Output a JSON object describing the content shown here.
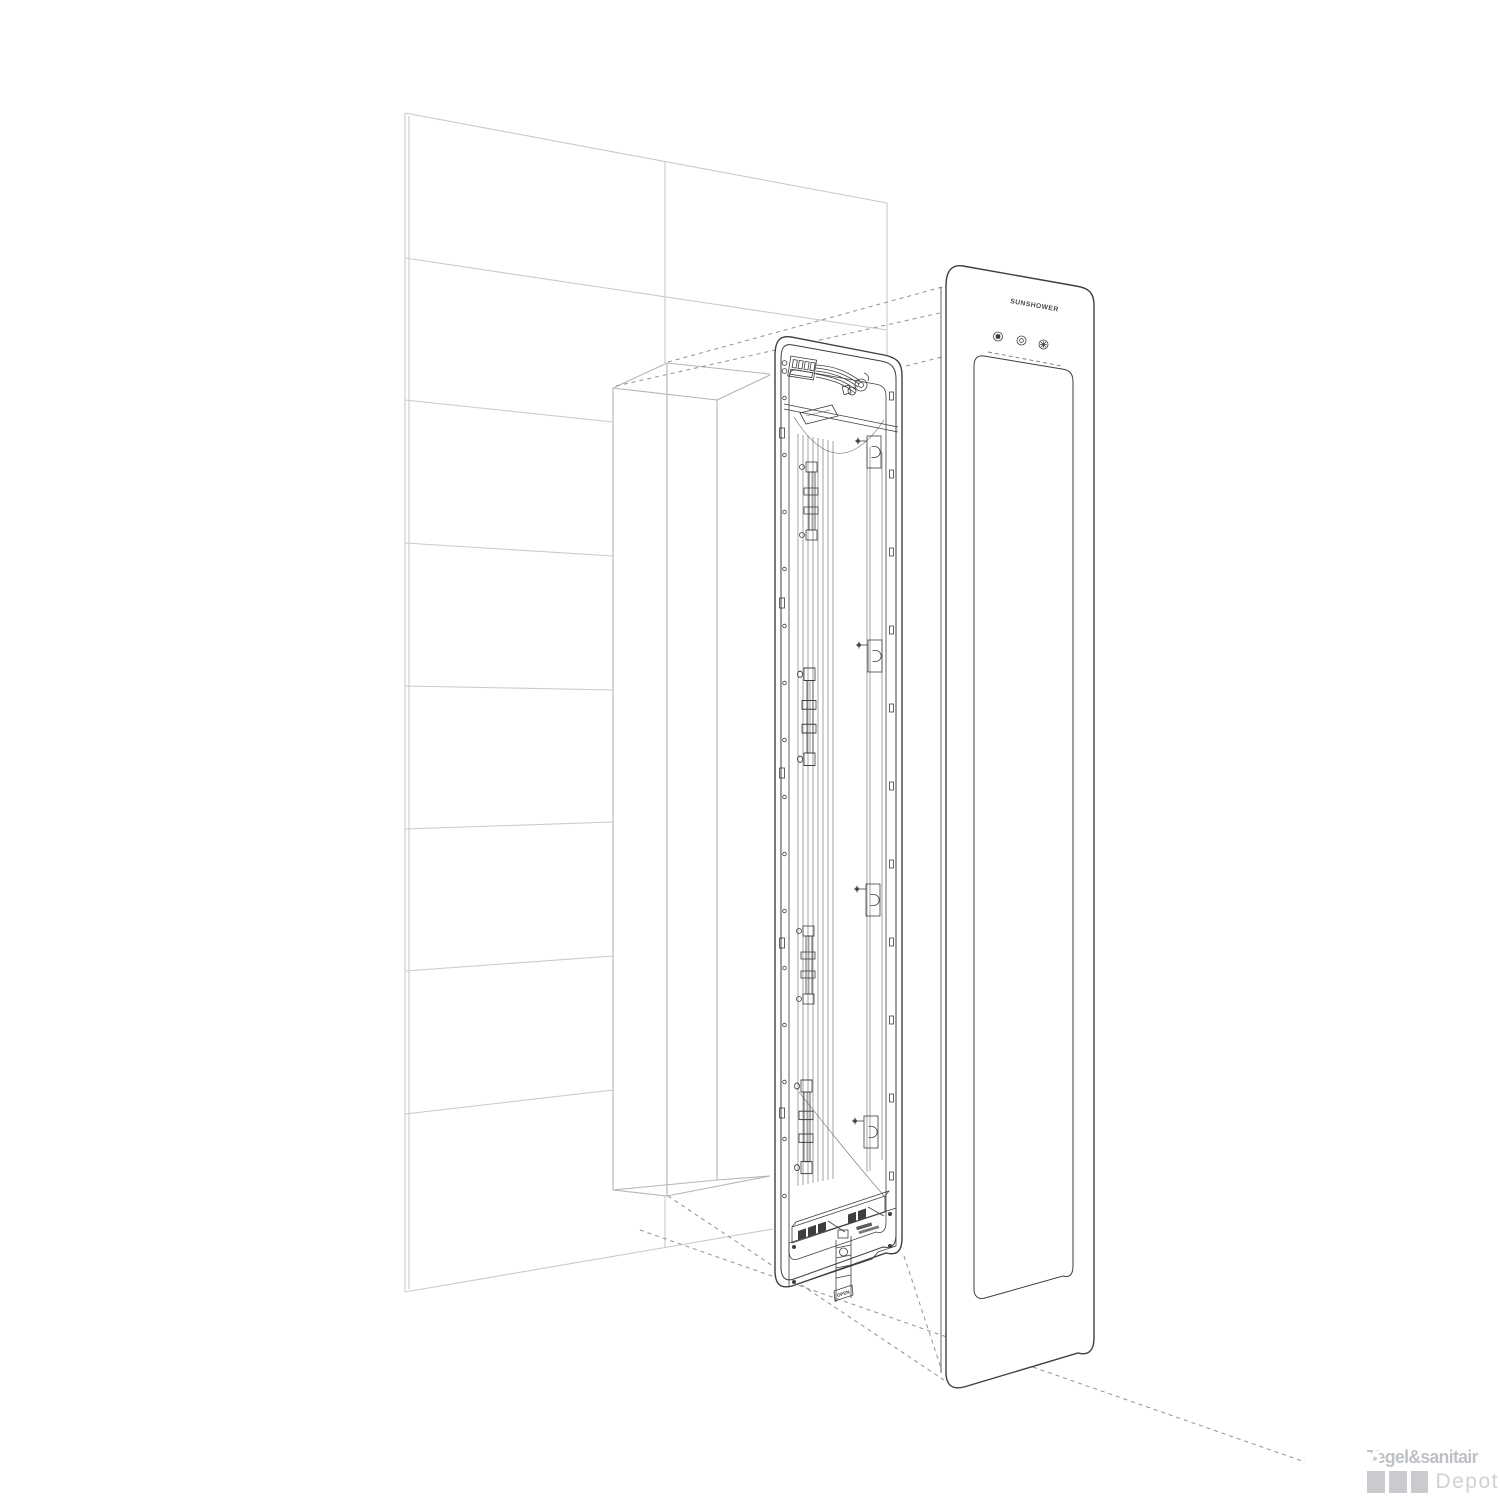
{
  "illustration": {
    "panel_logo": "SUNSHOWER",
    "open_label": "OPEN",
    "buttons": [
      {
        "icon": "square-display-icon"
      },
      {
        "icon": "clock-dot-icon"
      },
      {
        "icon": "sun-icon"
      }
    ]
  },
  "watermark": {
    "brand_bold": "Tegel&sanitair",
    "brand_light": "Depot",
    "tile_count": 3,
    "droplet_icon": "droplet-icon"
  },
  "colors": {
    "background": "#ffffff",
    "wall_line": "#c9cacb",
    "recess_line": "#b4b5b7",
    "unit_line": "#3e3e40",
    "dashed_line": "#909194",
    "brand_bold": "#bdc0c4",
    "brand_tile": "#c9cbcf",
    "brand_light": "#ced1d5"
  }
}
